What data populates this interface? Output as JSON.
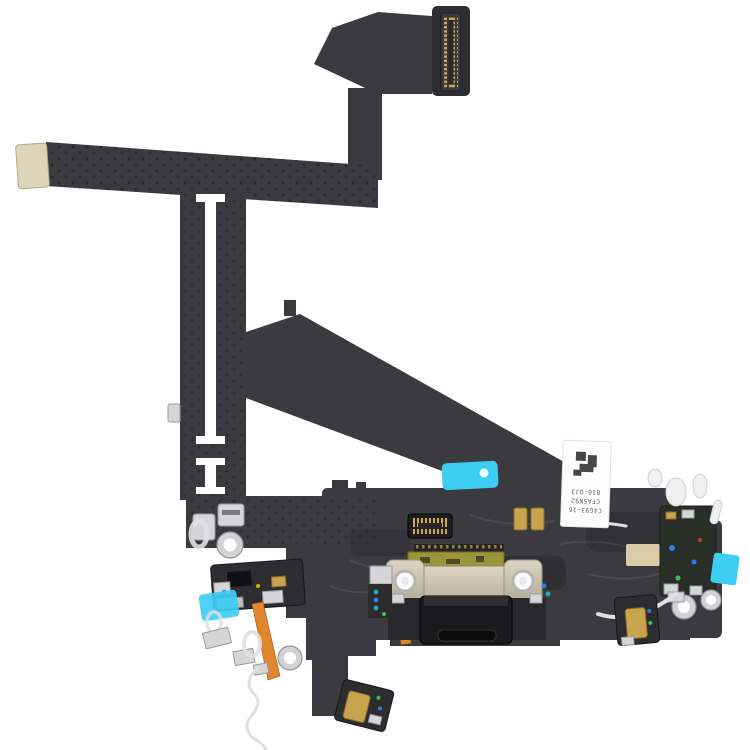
{
  "image": {
    "kind": "product-photo",
    "subject": "Charging port dock flex cable assembly (black), photographed on white",
    "background": "#ffffff"
  },
  "label": {
    "lines": [
      "C4G93-16",
      "CFASN92",
      "816-QJ3"
    ],
    "rotation_deg": 180
  },
  "colors": {
    "bg": "#ffffff",
    "flex_dark": "#3b3b3f",
    "flex_deep": "#2e2e32",
    "module_dark": "#2d2d31",
    "beige_pad": "#ded4ba",
    "gold": "#c9a44e",
    "gold_dark": "#8a6d2a",
    "metal": "#d6d6d8",
    "metal_dark": "#9a9aa0",
    "cyan_sticker": "#3ecdf3",
    "orange_flex": "#e0862e",
    "olive_pcb": "#9c9438",
    "port_black": "#1a1a1d",
    "wire_light": "#e0e0e2",
    "label_bg": "#fdfdfd",
    "label_text": "#63636a",
    "dot_blue": "#2f78e8",
    "dot_green": "#3bc14e",
    "dot_teal": "#2aa7b8"
  }
}
